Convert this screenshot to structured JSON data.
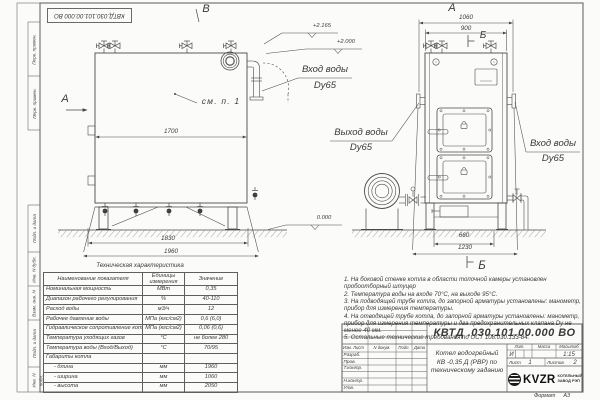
{
  "stamp": {
    "text": "КВТД.030.101.00.000  ВО"
  },
  "margin": {
    "items": [
      "Перв. примен.",
      "Перв. примен.",
      "Подп. и дата",
      "Инв. N дубл.",
      "Взам. инв. N",
      "Подп. и дата",
      "Инв. N подл."
    ]
  },
  "front_view": {
    "label_b": "В",
    "label_a": "А",
    "see_note": "см. п. 1",
    "dim_inner": "1700",
    "dim_1830": "1830",
    "dim_1960": "1960",
    "elev_top": "+2.165",
    "elev_mid": "+2.000",
    "elev_zero": "0.000",
    "inlet_line1": "Вход воды",
    "inlet_line2": "Dy65"
  },
  "side_view": {
    "label_a": "А",
    "label_b": "Б",
    "dim_1060": "1060",
    "dim_900": "900",
    "dim_660": "660",
    "dim_1230": "1230",
    "outlet_line1": "Выход воды",
    "outlet_line2": "Dy65",
    "inlet_line1": "Вход воды",
    "inlet_line2": "Dy65"
  },
  "spec_table": {
    "title": "Техническая характеристика",
    "headers": [
      "Наименование показателя",
      "Единицы измерения",
      "Значение"
    ],
    "rows": [
      [
        "Номинальная мощность",
        "МВт",
        "0,35"
      ],
      [
        "Диапазон рабочего регулирования",
        "%",
        "40-110"
      ],
      [
        "Расход воды",
        "м3/ч",
        "12"
      ],
      [
        "Рабочее давление воды",
        "МПа (кгс/см2)",
        "0,6 (6,0)"
      ],
      [
        "Гидравлическое сопротивление котла",
        "МПа (кгс/см2)",
        "0,06 (0,6)"
      ],
      [
        "Температура уходящих газов",
        "°С",
        "не более 280"
      ],
      [
        "Температура воды (Вход/Выход)",
        "°С",
        "70/95"
      ],
      [
        "Габариты котла",
        "",
        ""
      ],
      [
        "- длина",
        "мм",
        "1960"
      ],
      [
        "- ширина",
        "мм",
        "1060"
      ],
      [
        "- высота",
        "мм",
        "2050"
      ]
    ]
  },
  "notes": {
    "lines": [
      "1.  На боковой стенке котла в области топочной камеры установлен пробоотборный штуцер",
      "2.  Температура воды на входе 70°С, на выходе 95°С.",
      "3.  На подводящей трубе котла, до запорной арматуры установлены: манометр, прибор для измерения температуры.",
      "4.  На отводящей трубе котла, до запорной арматуры установлены: манометр, прибор для измерения температуры и два предохранительных клапана Dy не менее 40 мм.",
      "5.  Остальные технические требования по ОСТ 108.030.133-84."
    ]
  },
  "title_block": {
    "doc_number": "КВТД .030.101.00.000  ВО",
    "product_line1": "Котел водогрейный",
    "product_line2": "КВ -0,35 Д (РВР) по",
    "product_line3": "техническому заданию",
    "col_izm": "Изм. Лист",
    "col_doc": "N докум.",
    "col_sign": "Подп.",
    "col_date": "Дата",
    "row_labels": [
      "Разраб.",
      "Пров.",
      "Т.контр.",
      "Н.контр.",
      "Утв."
    ],
    "lit_label": "Лит.",
    "mass_label": "Масса",
    "scale_label": "Масштаб",
    "lit_value": "И",
    "scale_value": "1:15",
    "sheet_label": "Лист",
    "sheet_value": "1",
    "sheets_label": "Листов",
    "sheets_value": "2",
    "logo_text": "KVZR",
    "logo_sub1": "КОТЕЛЬНЫЙ",
    "logo_sub2": "ЗАВОД РЭП"
  },
  "footer": {
    "format_label": "Формат",
    "format_value": "А3"
  }
}
